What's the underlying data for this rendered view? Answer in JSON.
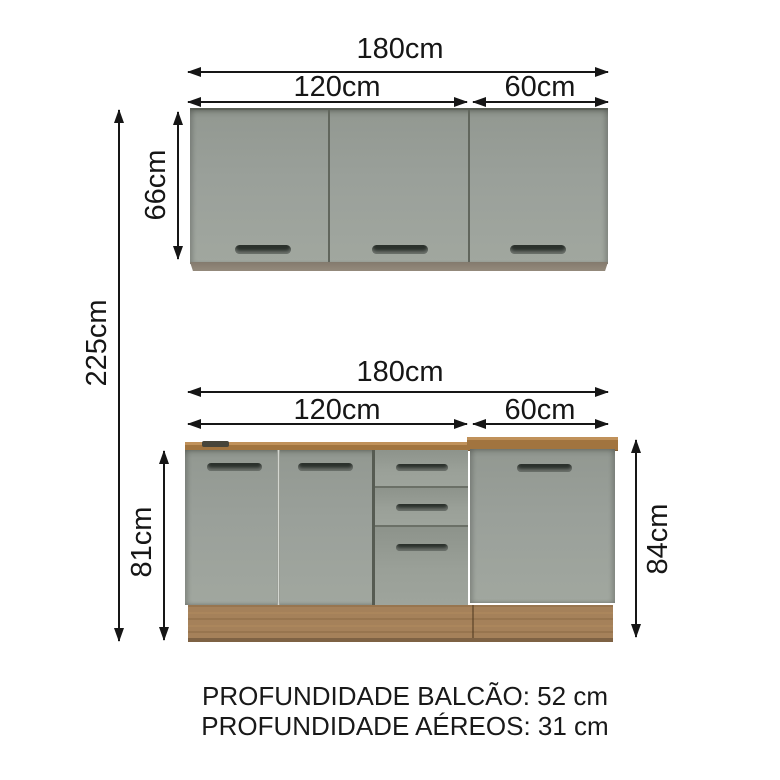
{
  "upper": {
    "total": "180cm",
    "left": "120cm",
    "right": "60cm",
    "height": "66cm"
  },
  "base": {
    "total": "180cm",
    "left": "120cm",
    "right": "60cm",
    "height_left": "81cm",
    "height_right": "84cm"
  },
  "overall": {
    "height": "225cm"
  },
  "footer": {
    "line1": "PROFUNDIDADE BALCÃO: 52 cm",
    "line2": "PROFUNDIDADE AÉREOS: 31 cm"
  },
  "colors": {
    "cabinet_gray": "#9aa09a",
    "countertop_wood": "#a1743f",
    "kick_wood": "#a5815a",
    "handle_dark": "#2b312c",
    "line": "#161616"
  }
}
